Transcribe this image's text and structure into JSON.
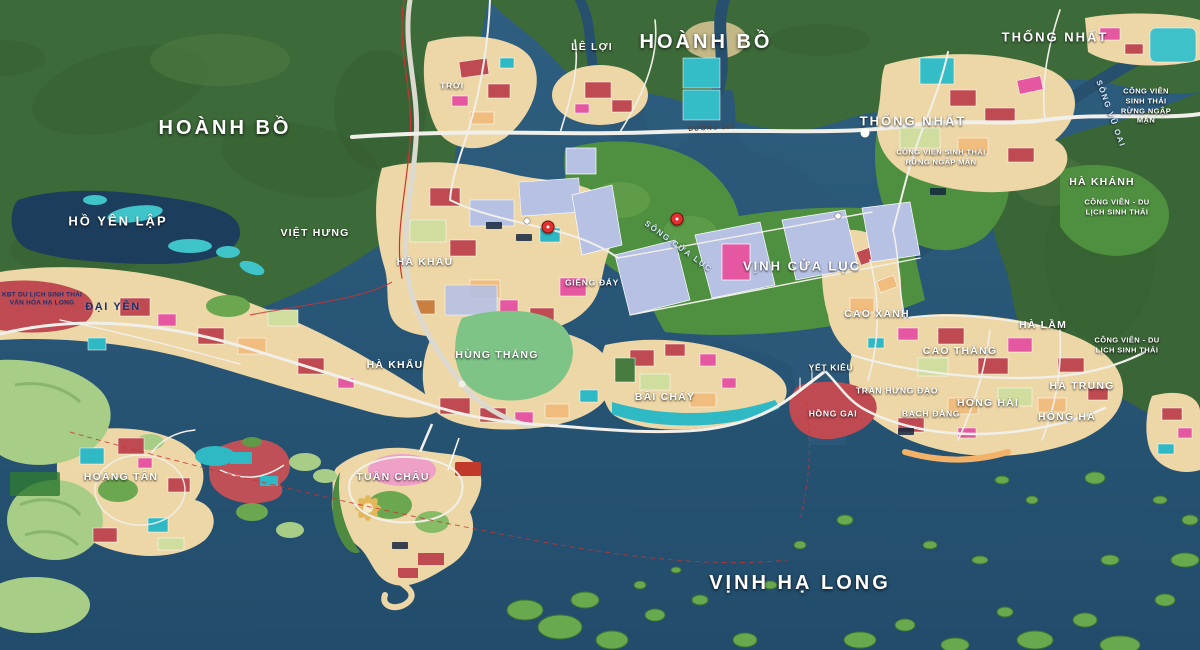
{
  "map": {
    "region": "Quy hoạch Hạ Long - Hoành Bồ (planning map)",
    "colors": {
      "sea": "#2b5878",
      "lake": "#1c3d5c",
      "forest": "#3d6a39",
      "mangrove_park": "#4f9040",
      "golf_green": "#a8cd86",
      "urban_cream": "#eed7a7",
      "parcel_red": "#bf4a52",
      "parcel_pink": "#e557a0",
      "parcel_lavender": "#b6c1e4",
      "parcel_teal": "#2fb9c4",
      "road": "#f0efe9",
      "boundary_red": "#c63434",
      "beach_sand": "#f3b268"
    },
    "labels": [
      {
        "id": "hoanh-bo-west",
        "text": "HOÀNH BỒ",
        "x": 225,
        "y": 128,
        "cls": "huge"
      },
      {
        "id": "troi",
        "text": "TRỚI",
        "x": 452,
        "y": 86,
        "cls": "small"
      },
      {
        "id": "le-loi",
        "text": "LÊ LỢI",
        "x": 592,
        "y": 48,
        "cls": "med"
      },
      {
        "id": "hoanh-bo-north",
        "text": "HOÀNH BỒ",
        "x": 706,
        "y": 42,
        "cls": "huge"
      },
      {
        "id": "thong-nhat-ne",
        "text": "THỐNG NHẤT",
        "x": 1055,
        "y": 38,
        "cls": "big"
      },
      {
        "id": "thong-nhat-e",
        "text": "THỐNG NHẤT",
        "x": 913,
        "y": 122,
        "cls": "big"
      },
      {
        "id": "cv-sinh-thai-rnm-e",
        "text": "CÔNG VIÊN SINH THÁI\nRỪNG NGẬP MẶN",
        "x": 1146,
        "y": 106,
        "cls": "park"
      },
      {
        "id": "cv-sinh-thai-rnm-s",
        "text": "CÔNG VIÊN SINH THÁI\nRỪNG NGẬP MẶN",
        "x": 941,
        "y": 157,
        "cls": "park"
      },
      {
        "id": "ha-khanh",
        "text": "HÀ KHÁNH",
        "x": 1102,
        "y": 183,
        "cls": "med"
      },
      {
        "id": "cv-du-lich-sinh-thai-n",
        "text": "CÔNG VIÊN - DU LỊCH SINH THÁI",
        "x": 1117,
        "y": 207,
        "cls": "park"
      },
      {
        "id": "ho-yen-lap",
        "text": "HỒ YÊN LẬP",
        "x": 118,
        "y": 222,
        "cls": "big"
      },
      {
        "id": "viet-hung",
        "text": "VIỆT HƯNG",
        "x": 315,
        "y": 234,
        "cls": "med"
      },
      {
        "id": "ha-khau-north",
        "text": "HÀ KHẨU",
        "x": 425,
        "y": 263,
        "cls": "med"
      },
      {
        "id": "song-cua-luc",
        "text": "SÔNG CỬA LỤC",
        "x": 678,
        "y": 247,
        "cls": "river",
        "rot": 36
      },
      {
        "id": "vinh-cua-luc",
        "text": "VỊNH CỬA LỤC",
        "x": 802,
        "y": 267,
        "cls": "big"
      },
      {
        "id": "gieng-day",
        "text": "GIẾNG ĐÁY",
        "x": 592,
        "y": 283,
        "cls": "small"
      },
      {
        "id": "dai-yen",
        "text": "ĐẠI YÊN",
        "x": 113,
        "y": 307,
        "cls": "dark"
      },
      {
        "id": "kdt-du-lich-sinh-thai",
        "text": "KĐT DU LỊCH SINH THÁI\nVĂN HÓA HẠ LONG",
        "x": 42,
        "y": 300,
        "cls": "tinydark"
      },
      {
        "id": "cao-xanh",
        "text": "CAO XANH",
        "x": 877,
        "y": 315,
        "cls": "med"
      },
      {
        "id": "ha-lam",
        "text": "HÀ LẦM",
        "x": 1043,
        "y": 326,
        "cls": "med"
      },
      {
        "id": "cao-thang",
        "text": "CAO THẮNG",
        "x": 960,
        "y": 352,
        "cls": "med"
      },
      {
        "id": "cv-du-lich-sinh-thai-e",
        "text": "CÔNG VIÊN - DU LỊCH SINH THÁI",
        "x": 1127,
        "y": 345,
        "cls": "park"
      },
      {
        "id": "hung-thang",
        "text": "HÙNG THẮNG",
        "x": 497,
        "y": 356,
        "cls": "med"
      },
      {
        "id": "ha-khau-south",
        "text": "HÀ KHẨU",
        "x": 395,
        "y": 366,
        "cls": "med"
      },
      {
        "id": "yet-kieu",
        "text": "YẾT KIÊU",
        "x": 831,
        "y": 368,
        "cls": "small"
      },
      {
        "id": "ha-trung",
        "text": "HÀ TRUNG",
        "x": 1082,
        "y": 387,
        "cls": "med"
      },
      {
        "id": "tran-hung-dao",
        "text": "TRẦN HƯNG ĐẠO",
        "x": 897,
        "y": 391,
        "cls": "small"
      },
      {
        "id": "bai-chay",
        "text": "BÃI CHÁY",
        "x": 665,
        "y": 398,
        "cls": "med"
      },
      {
        "id": "hong-hai",
        "text": "HỒNG HẢI",
        "x": 988,
        "y": 404,
        "cls": "med"
      },
      {
        "id": "hong-gai",
        "text": "HỒNG GAI",
        "x": 833,
        "y": 414,
        "cls": "small"
      },
      {
        "id": "bach-dang",
        "text": "BẠCH ĐẰNG",
        "x": 931,
        "y": 414,
        "cls": "small"
      },
      {
        "id": "hong-ha",
        "text": "HỒNG HÀ",
        "x": 1067,
        "y": 418,
        "cls": "med"
      },
      {
        "id": "hoang-tan",
        "text": "HOÀNG TÂN",
        "x": 121,
        "y": 478,
        "cls": "med"
      },
      {
        "id": "tuan-chau",
        "text": "TUẦN CHÂU",
        "x": 393,
        "y": 478,
        "cls": "med"
      },
      {
        "id": "vinh-ha-long",
        "text": "VỊNH HẠ LONG",
        "x": 800,
        "y": 583,
        "cls": "huge"
      },
      {
        "id": "duong-326",
        "text": "ĐƯỜNG 326",
        "x": 712,
        "y": 129,
        "cls": "road",
        "rot": -3
      },
      {
        "id": "song-vu-oai",
        "text": "SÔNG VŨ OAI",
        "x": 1110,
        "y": 114,
        "cls": "river",
        "rot": 70
      }
    ],
    "markers": [
      {
        "id": "park-marker-west",
        "x": 548,
        "y": 227
      },
      {
        "id": "park-marker-east",
        "x": 677,
        "y": 219
      }
    ]
  }
}
